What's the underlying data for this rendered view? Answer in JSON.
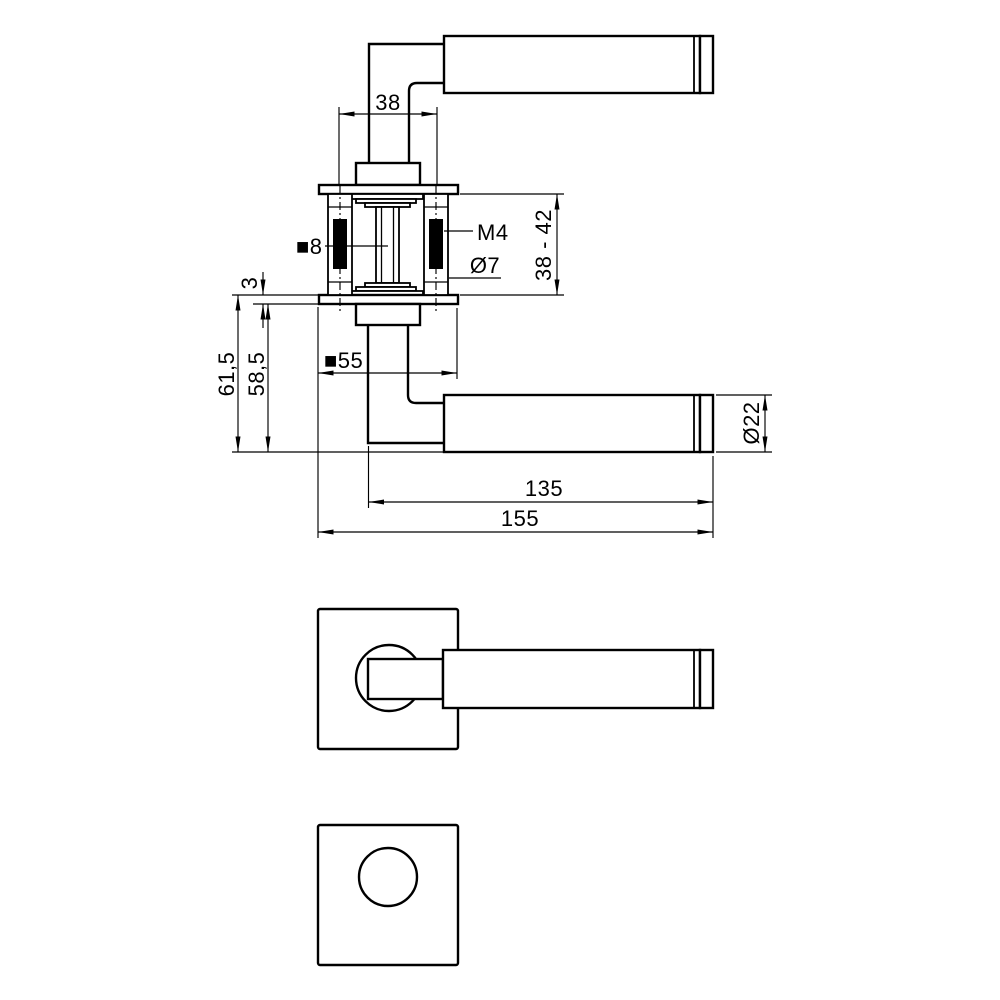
{
  "drawing": {
    "background_color": "#ffffff",
    "line_color": "#000000",
    "dimensions": {
      "screw_spacing": "38",
      "thread_size": "M4",
      "connector_diameter": "Ø7",
      "door_thickness_range": "38 - 42",
      "spindle_size": "■8",
      "rose_thickness": "3",
      "height_incl_rose": "61,5",
      "height_excl_rose": "58,5",
      "rose_size": "■55",
      "lever_length_inner": "135",
      "lever_length_total": "155",
      "grip_diameter": "Ø22"
    }
  }
}
